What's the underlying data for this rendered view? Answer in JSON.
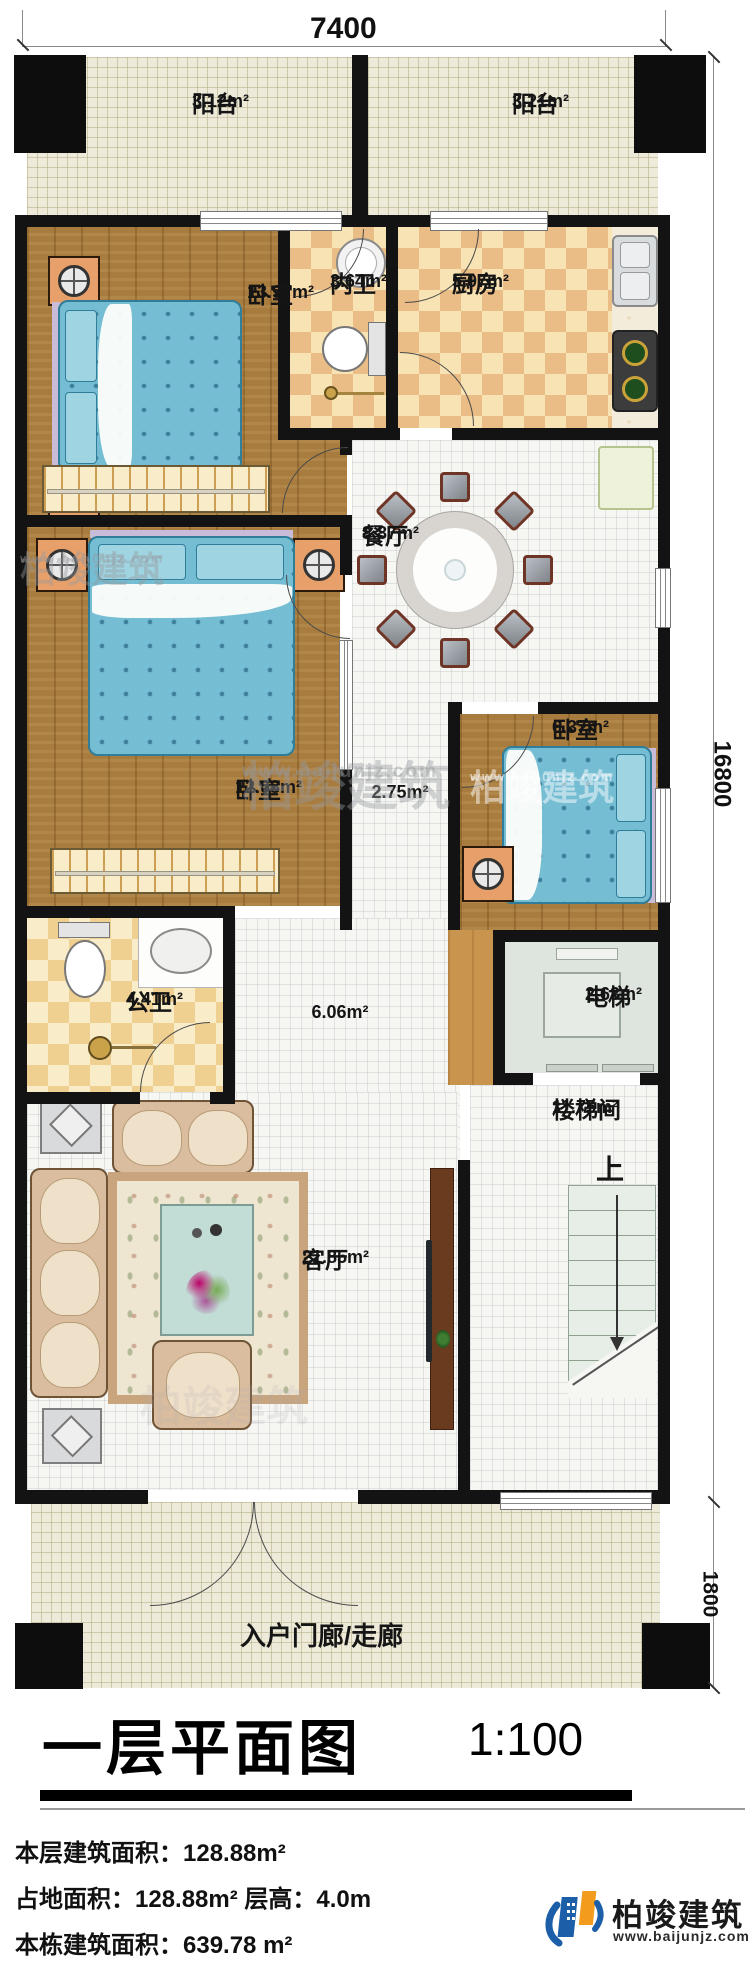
{
  "meta": {
    "title": "一层平面图",
    "scale": "1:100"
  },
  "dimensions": {
    "top": "7400",
    "right": "16800",
    "bottom_right": "1800"
  },
  "rooms": {
    "balcony_left": {
      "name": "阳台",
      "area": "3.12m²"
    },
    "balcony_right": {
      "name": "阳台",
      "area": "3.21m²"
    },
    "bedroom_master": {
      "name": "卧室",
      "area": "13.97m²"
    },
    "ensuite_bath": {
      "name": "内卫",
      "area": "3.64m²"
    },
    "kitchen": {
      "name": "厨房",
      "area": "5.07m²"
    },
    "dining": {
      "name": "餐厅",
      "area": "8.87m²"
    },
    "bedroom_small": {
      "name": "卧室",
      "area": "6.37m²"
    },
    "bedroom_second": {
      "name": "卧室",
      "area": "12.08m²"
    },
    "corridor": {
      "area": "2.75m²"
    },
    "public_bath": {
      "name": "公卫",
      "area": "4.41m²"
    },
    "hall": {
      "area": "6.06m²"
    },
    "elevator": {
      "name": "电梯",
      "area": "2.63m²"
    },
    "stairwell": {
      "name": "楼梯间",
      "area": "11.75m²",
      "direction": "上"
    },
    "living": {
      "name": "客厅",
      "area": "21.85m²"
    },
    "porch": {
      "name": "入户门廊/走廊"
    }
  },
  "info": {
    "line1": "本层建筑面积：128.88m²",
    "line2": "占地面积：128.88m²  层高：4.0m",
    "line3": "本栋建筑面积：639.78 m²"
  },
  "brand": {
    "name": "柏竣建筑",
    "url": "www.baijunjz.com"
  },
  "watermark": {
    "name": "柏竣建筑",
    "url": "www.baijunjz.com"
  },
  "colors": {
    "wall": "#131313",
    "wood_floor": "#a87c3e",
    "checker_tan": "#e9bd85",
    "checker_cream": "#f7e3b4",
    "bed_blue": "#74bdd3",
    "nightstand_orange": "#e8a06a",
    "brand_blue": "#1c5fa8",
    "brand_orange": "#f29b1d"
  }
}
